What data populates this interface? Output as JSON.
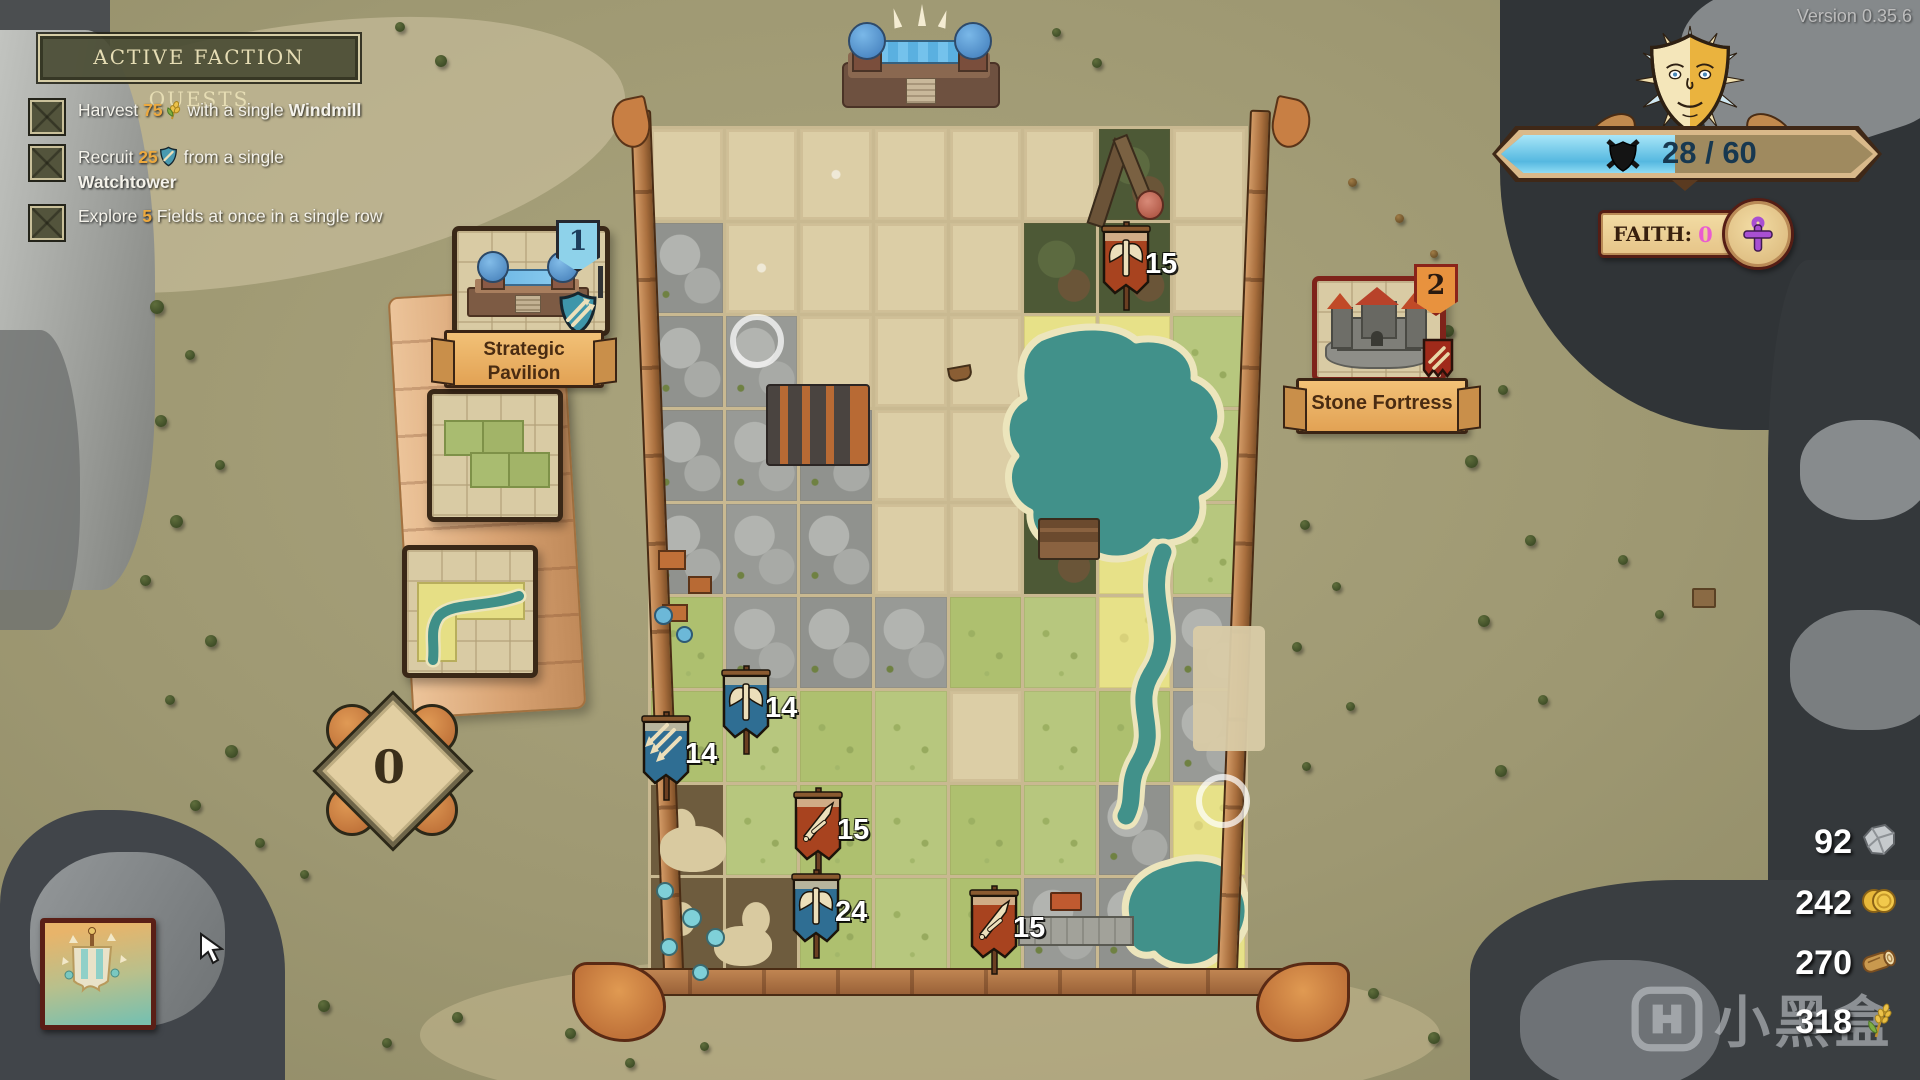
{
  "hud": {
    "version": "Version 0.35.6",
    "morale": {
      "value": "28 / 60",
      "current": 28,
      "max": 60
    },
    "faith": {
      "label": "FAITH:",
      "value": "0"
    }
  },
  "quest_panel": {
    "title": "ACTIVE FACTION QUESTS",
    "quests": [
      {
        "pre": "Harvest ",
        "value": "75",
        "icon": "wheat",
        "mid": " with a single ",
        "bold": "Windmill"
      },
      {
        "pre": "Recruit ",
        "value": "25",
        "icon": "shield",
        "mid": " from a single ",
        "bold": "Watchtower"
      },
      {
        "pre": "Explore ",
        "value": "5",
        "icon": "",
        "mid": " Fields at once in a single row",
        "bold": ""
      }
    ]
  },
  "cards": {
    "pavilion": {
      "count": "1",
      "name_line1": "Strategic",
      "name_line2": "Pavilion"
    },
    "fortress": {
      "count": "2",
      "name": "Stone Fortress"
    }
  },
  "tile_counter": {
    "value": "0"
  },
  "units": [
    {
      "value": "15",
      "color": "red",
      "icon": "axe"
    },
    {
      "value": "14",
      "color": "blue",
      "icon": "axe"
    },
    {
      "value": "14",
      "color": "blue",
      "icon": "arrows"
    },
    {
      "value": "15",
      "color": "red",
      "icon": "sword"
    },
    {
      "value": "24",
      "color": "blue",
      "icon": "axe"
    },
    {
      "value": "15",
      "color": "red",
      "icon": "sword"
    }
  ],
  "resources": [
    {
      "value": "92",
      "icon": "stone"
    },
    {
      "value": "242",
      "icon": "coins"
    },
    {
      "value": "270",
      "icon": "wood"
    },
    {
      "value": "318",
      "icon": "wheat"
    }
  ],
  "watermark": {
    "text": "小黑盒"
  },
  "board": {
    "rows": [
      "EEEEEEFE",
      "REEEEFFE",
      "RREEEYWG",
      "RRREEYWG",
      "RRREEFWG",
      "GRRRGGWR",
      "GGGGEGGR",
      "DGGGGGRW",
      "DDGGGRRW"
    ],
    "legend": {
      "E": "empty-slot",
      "R": "rock",
      "G": "grass",
      "Y": "field",
      "W": "water",
      "F": "forest",
      "D": "dirt-camp"
    }
  },
  "colors": {
    "accent_orange": "#eca93f",
    "morale_blue": "#55b8e0",
    "faith_pink": "#ea5cd0",
    "banner_red": "#a8431f",
    "banner_blue": "#2f6e93",
    "board_empty": "#dccea6",
    "grass": "#b7c77e",
    "field": "#e7e188",
    "water": "#41918a"
  }
}
